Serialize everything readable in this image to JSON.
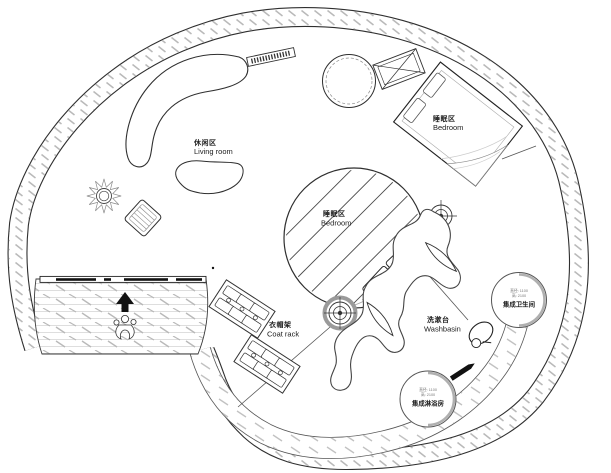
{
  "plan": {
    "type": "circular tiny-house floor plan",
    "labels": {
      "living": {
        "zh": "休闲区",
        "en": "Living room"
      },
      "bedroom_upper": {
        "zh": "睡眠区",
        "en": "Bedroom"
      },
      "bedroom_center": {
        "zh": "睡眠区",
        "en": "Bedroom"
      },
      "coat_rack": {
        "zh": "衣帽架",
        "en": "Coat rack"
      },
      "washbasin": {
        "zh": "洗漱台",
        "en": "Washbasin"
      },
      "bathroom_pod": {
        "name": "集成卫生间",
        "dim_line1": "直径: 1100",
        "dim_line2": "高: 2100"
      },
      "shower_pod": {
        "name": "集成淋浴房",
        "dim_line1": "直径: 1100",
        "dim_line2": "高: 2100"
      }
    },
    "colors": {
      "ink": "#2f2f2f",
      "hatch": "#b9b9b9",
      "deck_line": "#d4d4d4",
      "black": "#111111",
      "paper": "#ffffff"
    }
  }
}
